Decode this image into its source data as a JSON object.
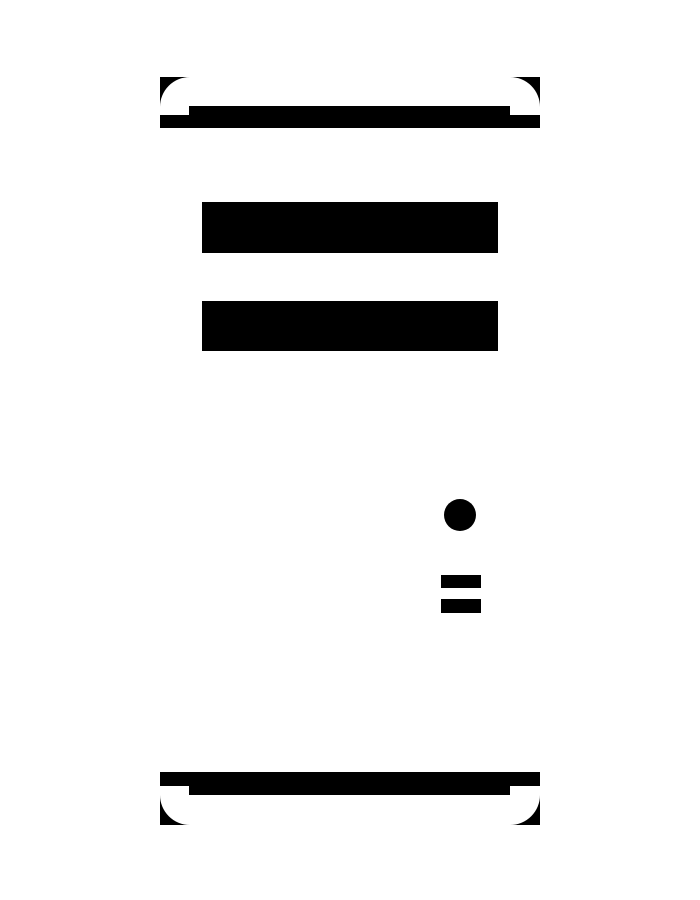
{
  "canvas": {
    "width": 700,
    "height": 900,
    "background": "#ffffff",
    "ink": "#000000"
  },
  "icon": {
    "label": "computer-tower-icon",
    "description": "High-contrast black-and-white pictogram of a desktop computer tower: rounded-corner case fragments at top and bottom, two drive bays, a power button and two vent slots",
    "bounds": {
      "x": 160,
      "y": 77,
      "width": 380,
      "height": 748
    },
    "corner_radius": 30,
    "paths": [
      {
        "name": "top-left-corner-wedge",
        "d": "M160 77 L190 77 A30 30 0 0 0 160 107 Z"
      },
      {
        "name": "top-right-corner-wedge",
        "d": "M540 77 L540 107 A30 30 0 0 0 510 77 Z"
      },
      {
        "name": "bottom-left-corner-wedge",
        "d": "M160 825 L160 795 A30 30 0 0 0 190 825 Z"
      },
      {
        "name": "bottom-right-corner-wedge",
        "d": "M540 825 L540 795 A30 30 0 0 1 510 825 Z"
      }
    ],
    "rects": [
      {
        "name": "top-band-inner-bar",
        "x": 189,
        "y": 106,
        "w": 321,
        "h": 9
      },
      {
        "name": "top-band-outer-bar",
        "x": 160,
        "y": 115,
        "w": 380,
        "h": 13
      },
      {
        "name": "drive-bay-1",
        "x": 202,
        "y": 202,
        "w": 296,
        "h": 51
      },
      {
        "name": "drive-bay-2",
        "x": 202,
        "y": 301,
        "w": 296,
        "h": 50
      },
      {
        "name": "vent-slot-1",
        "x": 441,
        "y": 575,
        "w": 40,
        "h": 13
      },
      {
        "name": "vent-slot-2",
        "x": 441,
        "y": 599,
        "w": 40,
        "h": 14
      },
      {
        "name": "bottom-band-outer-bar",
        "x": 160,
        "y": 772,
        "w": 380,
        "h": 14
      },
      {
        "name": "bottom-band-inner-bar",
        "x": 189,
        "y": 786,
        "w": 321,
        "h": 9
      }
    ],
    "circles": [
      {
        "name": "power-button-icon",
        "cx": 460,
        "cy": 515,
        "r": 16
      }
    ]
  }
}
